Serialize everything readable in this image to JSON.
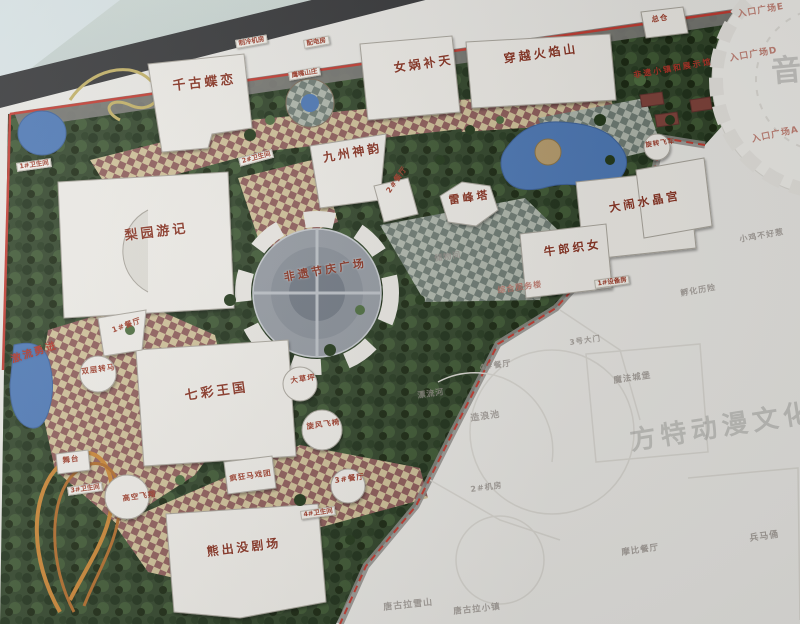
{
  "palette": {
    "label_red": "#9c3a28",
    "boundary_red": "#c0392f",
    "water_blue": "#4a76b4",
    "foliage_green": "#2e4227",
    "path_tan": "#cebf96",
    "path_maroon": "#8c5a57",
    "faded_area": "#e9e8e4",
    "building_white": "#edebe6",
    "wall_grey": "#c7d2cf"
  },
  "map": {
    "labels": [
      {
        "id": "qiangu-dielian",
        "text": "千古蝶恋",
        "kind": "big",
        "x": 172,
        "y": 80,
        "rot": -6,
        "fs": 13
      },
      {
        "id": "nuwa-butian",
        "text": "女娲补天",
        "kind": "big",
        "x": 393,
        "y": 62,
        "rot": -8,
        "fs": 12
      },
      {
        "id": "chuanyue-huoyanshan",
        "text": "穿越火焰山",
        "kind": "big",
        "x": 503,
        "y": 53,
        "rot": -8,
        "fs": 12
      },
      {
        "id": "jiuzhou-shenyun",
        "text": "九州神韵",
        "kind": "big",
        "x": 322,
        "y": 152,
        "rot": -10,
        "fs": 12
      },
      {
        "id": "leifengta",
        "text": "雷峰塔",
        "kind": "big",
        "x": 448,
        "y": 195,
        "rot": -8,
        "fs": 11
      },
      {
        "id": "danao-shuijinggong",
        "text": "大闹水晶宫",
        "kind": "big",
        "x": 608,
        "y": 202,
        "rot": -10,
        "fs": 11.5
      },
      {
        "id": "niulang-zhinv",
        "text": "牛郎织女",
        "kind": "big",
        "x": 543,
        "y": 246,
        "rot": -8,
        "fs": 11.5
      },
      {
        "id": "liyuan-youji",
        "text": "梨园游记",
        "kind": "big",
        "x": 124,
        "y": 230,
        "rot": -7,
        "fs": 13
      },
      {
        "id": "feiyi-jieqing-guangchang",
        "text": "非遗节庆广场",
        "kind": "big",
        "x": 283,
        "y": 272,
        "rot": -10,
        "fs": 11
      },
      {
        "id": "qicai-wangguo",
        "text": "七彩王国",
        "kind": "big",
        "x": 184,
        "y": 390,
        "rot": -8,
        "fs": 13
      },
      {
        "id": "xiongchumo-juchang",
        "text": "熊出没剧场",
        "kind": "big",
        "x": 206,
        "y": 546,
        "rot": -7,
        "fs": 12
      },
      {
        "id": "jiliu-yongjin",
        "text": "激流勇进",
        "kind": "red",
        "x": 10,
        "y": 355,
        "rot": -18,
        "fs": 10
      },
      {
        "id": "feiyi-xiaozhen-zhanshiguan",
        "text": "非遗小镇和展示馆",
        "kind": "red",
        "x": 633,
        "y": 72,
        "rot": -10,
        "fs": 8
      },
      {
        "id": "zongcang",
        "text": "总仓",
        "kind": "small",
        "x": 651,
        "y": 16,
        "rot": -8,
        "fs": 7.5
      },
      {
        "id": "shuangceng-zhuanma",
        "text": "双层转马",
        "kind": "small",
        "x": 81,
        "y": 368,
        "rot": -8,
        "fs": 7.5
      },
      {
        "id": "dacaoping",
        "text": "大草坪",
        "kind": "small",
        "x": 290,
        "y": 377,
        "rot": -8,
        "fs": 7.5
      },
      {
        "id": "xuanfeng-feiyi",
        "text": "旋风飞椅",
        "kind": "small",
        "x": 306,
        "y": 423,
        "rot": -8,
        "fs": 7.5
      },
      {
        "id": "fengkuang-maxituan",
        "text": "疯狂马戏团",
        "kind": "small",
        "x": 229,
        "y": 475,
        "rot": -8,
        "fs": 7.5
      },
      {
        "id": "gaokong-feixiang",
        "text": "高空飞翔",
        "kind": "small",
        "x": 122,
        "y": 495,
        "rot": -8,
        "fs": 7.5
      },
      {
        "id": "wutai",
        "text": "舞台",
        "kind": "small",
        "x": 62,
        "y": 457,
        "rot": -8,
        "fs": 7.5
      },
      {
        "id": "canting-1",
        "text": "1#餐厅",
        "kind": "small",
        "x": 111,
        "y": 327,
        "rot": -20,
        "fs": 7.5
      },
      {
        "id": "canting-2",
        "text": "2#餐厅",
        "kind": "small",
        "x": 385,
        "y": 190,
        "rot": -55,
        "fs": 7.5
      },
      {
        "id": "canting-3",
        "text": "3#餐厅",
        "kind": "small",
        "x": 334,
        "y": 477,
        "rot": -8,
        "fs": 7.5
      },
      {
        "id": "xuanzhuan-feiche",
        "text": "旋转飞车",
        "kind": "small",
        "x": 645,
        "y": 142,
        "rot": -8,
        "fs": 6.5
      },
      {
        "id": "weishengjian-1",
        "text": "1#卫生间",
        "kind": "chip",
        "x": 16,
        "y": 163,
        "rot": -8,
        "fs": 6.5
      },
      {
        "id": "weishengjian-2",
        "text": "2#卫生间",
        "kind": "chip",
        "x": 238,
        "y": 158,
        "rot": -15,
        "fs": 6.5
      },
      {
        "id": "weishengjian-3",
        "text": "3#卫生间",
        "kind": "chip",
        "x": 67,
        "y": 487,
        "rot": -8,
        "fs": 6.5
      },
      {
        "id": "weishengjian-4",
        "text": "4#卫生间",
        "kind": "chip",
        "x": 300,
        "y": 511,
        "rot": -8,
        "fs": 6.5
      },
      {
        "id": "zhileng-jifang",
        "text": "制冷机房",
        "kind": "chip",
        "x": 235,
        "y": 40,
        "rot": -10,
        "fs": 6.5
      },
      {
        "id": "peidianfang",
        "text": "配电房",
        "kind": "chip",
        "x": 303,
        "y": 40,
        "rot": -10,
        "fs": 6.5
      },
      {
        "id": "yingzui-shanzhuang",
        "text": "鹰嘴山庄",
        "kind": "chip",
        "x": 288,
        "y": 72,
        "rot": -10,
        "fs": 6.5
      },
      {
        "id": "shebeifang-1",
        "text": "1#设备房",
        "kind": "chip",
        "x": 594,
        "y": 280,
        "rot": -8,
        "fs": 6.5
      },
      {
        "id": "rukou-guangchang-e",
        "text": "入口广场E",
        "kind": "faintred",
        "x": 737,
        "y": 11,
        "rot": -10,
        "fs": 9
      },
      {
        "id": "rukou-guangchang-d",
        "text": "入口广场D",
        "kind": "faintred",
        "x": 729,
        "y": 55,
        "rot": -10,
        "fs": 9
      },
      {
        "id": "rukou-guangchang-a",
        "text": "入口广场A",
        "kind": "faintred",
        "x": 751,
        "y": 136,
        "rot": -12,
        "fs": 9
      },
      {
        "id": "zonghe-fuwulou",
        "text": "综合服务楼",
        "kind": "faintred",
        "x": 497,
        "y": 287,
        "rot": -8,
        "fs": 8
      },
      {
        "id": "chuwujian",
        "text": "储物间",
        "kind": "ghost",
        "x": 434,
        "y": 255,
        "rot": -8,
        "fs": 8
      },
      {
        "id": "xiaoji-buhaore",
        "text": "小鸡不好惹",
        "kind": "ghost",
        "x": 739,
        "y": 236,
        "rot": -10,
        "fs": 8
      },
      {
        "id": "fuhua-lixian",
        "text": "孵化历险",
        "kind": "ghost",
        "x": 680,
        "y": 290,
        "rot": -10,
        "fs": 8
      },
      {
        "id": "canting-4",
        "text": "4#餐厅",
        "kind": "ghost",
        "x": 479,
        "y": 364,
        "rot": -8,
        "fs": 8
      },
      {
        "id": "piaoliuhe",
        "text": "漂流河",
        "kind": "ghost",
        "x": 417,
        "y": 392,
        "rot": -8,
        "fs": 8
      },
      {
        "id": "zaolangchi",
        "text": "造浪池",
        "kind": "ghost",
        "x": 470,
        "y": 415,
        "rot": -8,
        "fs": 9
      },
      {
        "id": "mofa-chengbao",
        "text": "魔法城堡",
        "kind": "ghost",
        "x": 613,
        "y": 377,
        "rot": -8,
        "fs": 8.5
      },
      {
        "id": "jifang-2",
        "text": "2#机房",
        "kind": "ghost",
        "x": 470,
        "y": 486,
        "rot": -8,
        "fs": 8
      },
      {
        "id": "damen-3",
        "text": "3号大门",
        "kind": "ghost",
        "x": 569,
        "y": 339,
        "rot": -8,
        "fs": 7.5
      },
      {
        "id": "bingmayong",
        "text": "兵马俑",
        "kind": "ghost",
        "x": 749,
        "y": 535,
        "rot": -8,
        "fs": 9
      },
      {
        "id": "mobi-canting",
        "text": "摩比餐厅",
        "kind": "ghost",
        "x": 621,
        "y": 549,
        "rot": -8,
        "fs": 8.5
      },
      {
        "id": "tanggula-xueshan",
        "text": "唐古拉雪山",
        "kind": "ghost",
        "x": 383,
        "y": 604,
        "rot": -6,
        "fs": 9
      },
      {
        "id": "tanggula-xiaozhen",
        "text": "唐古拉小镇",
        "kind": "ghost",
        "x": 453,
        "y": 608,
        "rot": -6,
        "fs": 8.5
      },
      {
        "id": "watermark-fangte-donman-wenhua-keji",
        "text": "方特动漫文化科技",
        "kind": "wm",
        "x": 628,
        "y": 428,
        "rot": -9,
        "fs": 26
      },
      {
        "id": "watermark-yin",
        "text": "音",
        "kind": "wm",
        "x": 770,
        "y": 56,
        "rot": -5,
        "fs": 30
      }
    ]
  }
}
